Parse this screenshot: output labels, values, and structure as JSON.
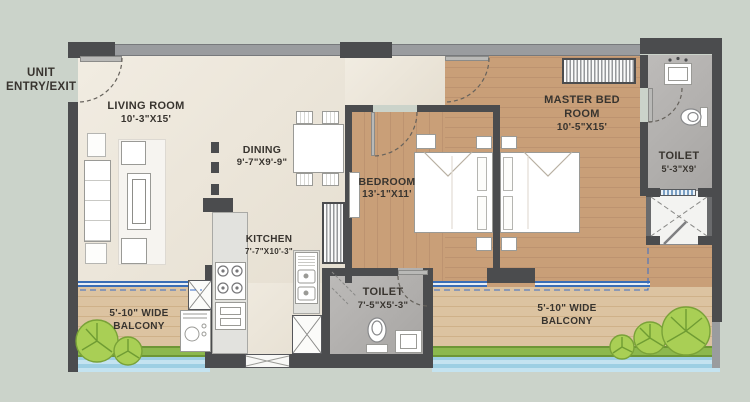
{
  "plan": {
    "entry_label": "UNIT ENTRY/EXIT",
    "rooms": [
      {
        "name": "LIVING ROOM",
        "dim": "10'-3\"X15'"
      },
      {
        "name": "DINING",
        "dim": "9'-7\"X9'-9\""
      },
      {
        "name": "KITCHEN",
        "dim": "7'-7\"X10'-3\""
      },
      {
        "name": "BEDROOM",
        "dim": "13'-1\"X11'"
      },
      {
        "name": "MASTER BED ROOM",
        "dim": "10'-5\"X15'"
      },
      {
        "name": "TOILET",
        "dim": "7'-5\"X5'-3\""
      },
      {
        "name": "TOILET",
        "dim": "5'-3\"X9'"
      }
    ],
    "balcony_left_label": "5'-10\" WIDE BALCONY",
    "balcony_right_label": "5'-10\" WIDE BALCONY",
    "colors": {
      "background": "#cbd3ca",
      "wall_dark": "#4b4c4e",
      "wall_light": "#9a9c9f",
      "floor_cream": "#ede6d8",
      "floor_wood": "#c8a27e",
      "floor_balcony": "#dcc3a1",
      "floor_toilet": "#b3b1af",
      "planter_green": "#8cb84e",
      "water_blue": "#aed7e8",
      "window_blue": "#3a6db5"
    }
  }
}
